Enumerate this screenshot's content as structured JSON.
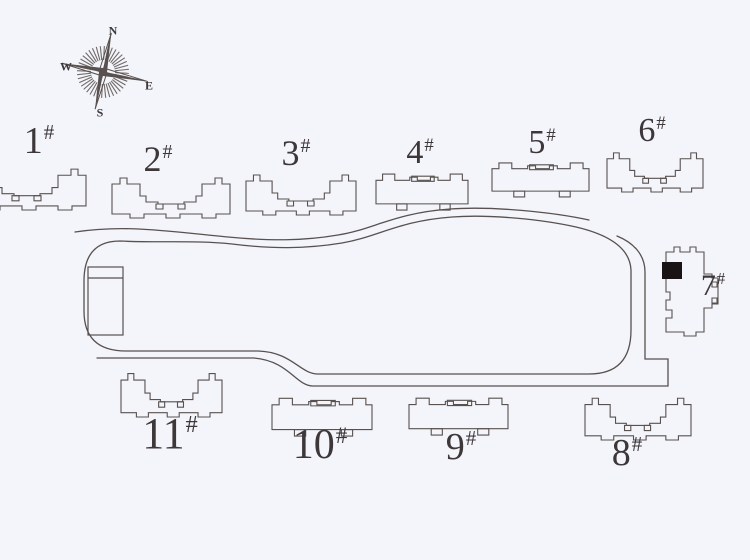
{
  "title": "residential-compound-site-plan",
  "colors": {
    "background": "#f3f5fa",
    "line": "#59514f",
    "label": "#3e3739",
    "highlight": "#191316"
  },
  "compass": {
    "cx": 103,
    "cy": 72,
    "rotation_deg": 12,
    "labels": {
      "n": "N",
      "e": "E",
      "s": "S",
      "w": "W"
    },
    "label_pos": {
      "n": [
        113,
        31
      ],
      "e": [
        149,
        86
      ],
      "s": [
        100,
        113
      ],
      "w": [
        66,
        67
      ]
    }
  },
  "buildings": [
    {
      "id": "1",
      "label": "1",
      "hash": "#",
      "type": "uslab",
      "x": -32,
      "y": 163,
      "w": 118,
      "h": 47,
      "label_x": 39,
      "label_y": 122,
      "label_size": 38
    },
    {
      "id": "2",
      "label": "2",
      "hash": "#",
      "type": "uslab",
      "x": 112,
      "y": 172,
      "w": 118,
      "h": 46,
      "label_x": 158,
      "label_y": 141,
      "label_size": 36
    },
    {
      "id": "3",
      "label": "3",
      "hash": "#",
      "type": "uslab",
      "x": 246,
      "y": 169,
      "w": 110,
      "h": 46,
      "label_x": 296,
      "label_y": 135,
      "label_size": 36
    },
    {
      "id": "4",
      "label": "4",
      "hash": "#",
      "type": "flat",
      "x": 376,
      "y": 170,
      "w": 92,
      "h": 39,
      "label_x": 420,
      "label_y": 136,
      "label_size": 34
    },
    {
      "id": "5",
      "label": "5",
      "hash": "#",
      "type": "flat",
      "x": 492,
      "y": 159,
      "w": 97,
      "h": 37,
      "label_x": 542,
      "label_y": 126,
      "label_size": 34
    },
    {
      "id": "6",
      "label": "6",
      "hash": "#",
      "type": "uslab",
      "x": 607,
      "y": 147,
      "w": 96,
      "h": 45,
      "label_x": 652,
      "label_y": 114,
      "label_size": 34
    },
    {
      "id": "7",
      "label": "7",
      "hash": "#",
      "type": "tower",
      "x": 660,
      "y": 244,
      "w": 60,
      "h": 96,
      "label_x": 713,
      "label_y": 271,
      "label_size": 30
    },
    {
      "id": "8",
      "label": "8",
      "hash": "#",
      "type": "uslab",
      "x": 585,
      "y": 392,
      "w": 106,
      "h": 48,
      "label_x": 627,
      "label_y": 434,
      "label_size": 38
    },
    {
      "id": "9",
      "label": "9",
      "hash": "#",
      "type": "flat",
      "x": 409,
      "y": 394,
      "w": 99,
      "h": 40,
      "label_x": 461,
      "label_y": 428,
      "label_size": 38
    },
    {
      "id": "10",
      "label": "10",
      "hash": "#",
      "type": "flat",
      "x": 272,
      "y": 394,
      "w": 100,
      "h": 41,
      "label_x": 320,
      "label_y": 424,
      "label_size": 42
    },
    {
      "id": "11",
      "label": "11",
      "hash": "#",
      "type": "uslab",
      "x": 121,
      "y": 367,
      "w": 101,
      "h": 50,
      "label_x": 170,
      "label_y": 412,
      "label_size": 44
    }
  ],
  "structures": [
    {
      "name": "utility-structure",
      "x": 88,
      "y": 267,
      "w": 35,
      "h": 68,
      "divider_y": 278
    }
  ]
}
